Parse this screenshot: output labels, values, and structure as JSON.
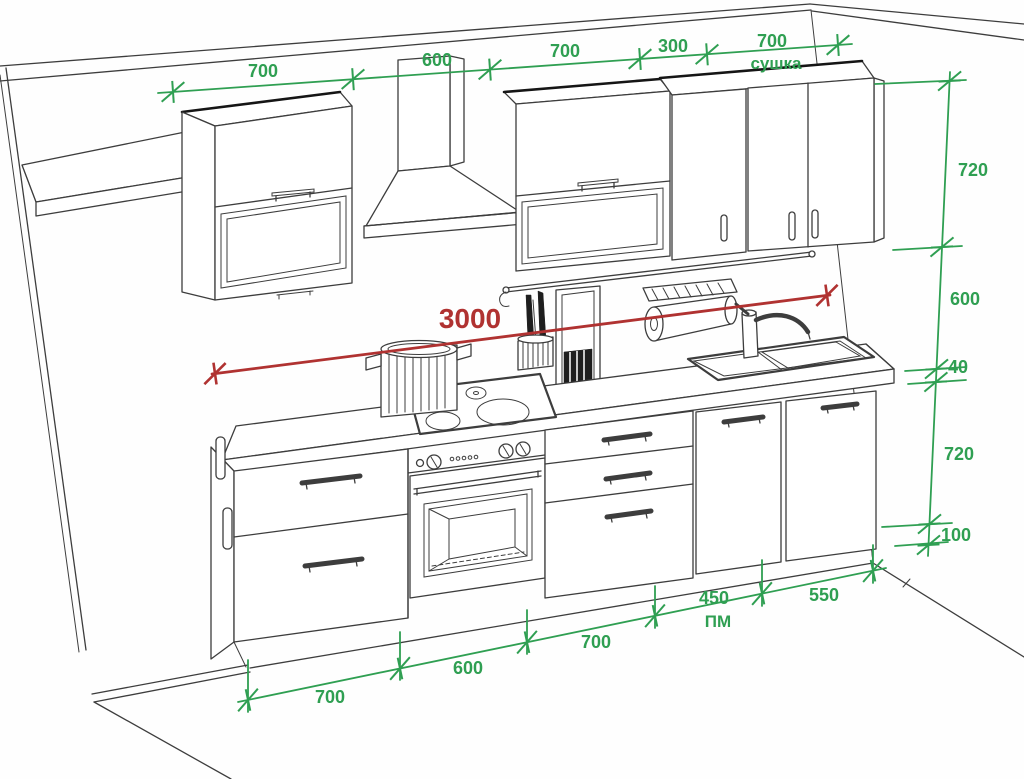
{
  "title": "Kitchen elevation drawing with dimensions",
  "colors": {
    "dimension_green": "#2f9f52",
    "total_red": "#b03231",
    "outline": "#3d3d3d",
    "background": "#ffffff"
  },
  "dims": {
    "top": [
      "700",
      "600",
      "700",
      "300",
      "700"
    ],
    "top_note": "сушка",
    "right": [
      "720",
      "600",
      "40",
      "720",
      "100"
    ],
    "bottom": [
      "700",
      "600",
      "700",
      "450",
      "550"
    ],
    "bottom_note": "ПМ",
    "total": "3000"
  }
}
